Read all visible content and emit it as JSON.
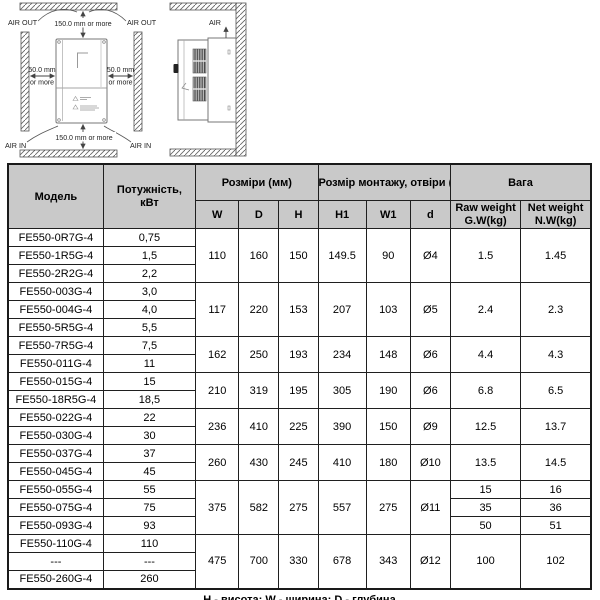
{
  "diagram": {
    "front": {
      "air_out_left": "AIR OUT",
      "air_out_right": "AIR OUT",
      "air_in_left": "AIR IN",
      "air_in_right": "AIR IN",
      "clearance_top": "150.0 mm or more",
      "clearance_bottom": "150.0 mm or more",
      "clearance_left_line1": "50.0 mm",
      "clearance_left_line2": "or more",
      "clearance_right_line1": "50.0 mm",
      "clearance_right_line2": "or more"
    },
    "side": {
      "air_label": "AIR"
    }
  },
  "table": {
    "header": {
      "model": "Модель",
      "power_line1": "Потужність,",
      "power_line2": "кВт",
      "dimensions": "Розміри (мм)",
      "mounting": "Розмір монтажу, отвіри  (мм)",
      "weight": "Вага",
      "col_w": "W",
      "col_d": "D",
      "col_h": "H",
      "col_h1": "H1",
      "col_w1": "W1",
      "col_hole": "d",
      "raw_line1": "Raw weight",
      "raw_line2": "G.W(kg)",
      "net_line1": "Net weight",
      "net_line2": "N.W(kg)"
    },
    "groups": [
      {
        "dims": {
          "w": "110",
          "d": "160",
          "h": "150",
          "h1": "149.5",
          "w1": "90",
          "hole": "Ø4"
        },
        "gw": "1.5",
        "nw": "1.45",
        "rows": [
          {
            "model": "FE550-0R7G-4",
            "power": "0,75"
          },
          {
            "model": "FE550-1R5G-4",
            "power": "1,5"
          },
          {
            "model": "FE550-2R2G-4",
            "power": "2,2"
          }
        ]
      },
      {
        "dims": {
          "w": "117",
          "d": "220",
          "h": "153",
          "h1": "207",
          "w1": "103",
          "hole": "Ø5"
        },
        "gw": "2.4",
        "nw": "2.3",
        "rows": [
          {
            "model": "FE550-003G-4",
            "power": "3,0"
          },
          {
            "model": "FE550-004G-4",
            "power": "4,0"
          },
          {
            "model": "FE550-5R5G-4",
            "power": "5,5"
          }
        ]
      },
      {
        "dims": {
          "w": "162",
          "d": "250",
          "h": "193",
          "h1": "234",
          "w1": "148",
          "hole": "Ø6"
        },
        "gw": "4.4",
        "nw": "4.3",
        "rows": [
          {
            "model": "FE550-7R5G-4",
            "power": "7,5"
          },
          {
            "model": "FE550-011G-4",
            "power": "11"
          }
        ]
      },
      {
        "dims": {
          "w": "210",
          "d": "319",
          "h": "195",
          "h1": "305",
          "w1": "190",
          "hole": "Ø6"
        },
        "gw": "6.8",
        "nw": "6.5",
        "rows": [
          {
            "model": "FE550-015G-4",
            "power": "15"
          },
          {
            "model": "FE550-18R5G-4",
            "power": "18,5"
          }
        ]
      },
      {
        "dims": {
          "w": "236",
          "d": "410",
          "h": "225",
          "h1": "390",
          "w1": "150",
          "hole": "Ø9"
        },
        "gw": "12.5",
        "nw": "13.7",
        "rows": [
          {
            "model": "FE550-022G-4",
            "power": "22"
          },
          {
            "model": "FE550-030G-4",
            "power": "30"
          }
        ]
      },
      {
        "dims": {
          "w": "260",
          "d": "430",
          "h": "245",
          "h1": "410",
          "w1": "180",
          "hole": "Ø10"
        },
        "gw": "13.5",
        "nw": "14.5",
        "rows": [
          {
            "model": "FE550-037G-4",
            "power": "37"
          },
          {
            "model": "FE550-045G-4",
            "power": "45"
          }
        ]
      },
      {
        "dims": {
          "w": "375",
          "d": "582",
          "h": "275",
          "h1": "557",
          "w1": "275",
          "hole": "Ø11"
        },
        "rows": [
          {
            "model": "FE550-055G-4",
            "power": "55",
            "gw": "15",
            "nw": "16"
          },
          {
            "model": "FE550-075G-4",
            "power": "75",
            "gw": "35",
            "nw": "36"
          },
          {
            "model": "FE550-093G-4",
            "power": "93",
            "gw": "50",
            "nw": "51"
          }
        ]
      },
      {
        "dims": {
          "w": "475",
          "d": "700",
          "h": "330",
          "h1": "678",
          "w1": "343",
          "hole": "Ø12"
        },
        "gw": "100",
        "nw": "102",
        "rows": [
          {
            "model": "FE550-110G-4",
            "power": "110"
          },
          {
            "model": "---",
            "power": "---"
          },
          {
            "model": "FE550-260G-4",
            "power": "260"
          }
        ]
      }
    ]
  },
  "caption": "Н - висота; W - ширина;  D -  глубина"
}
